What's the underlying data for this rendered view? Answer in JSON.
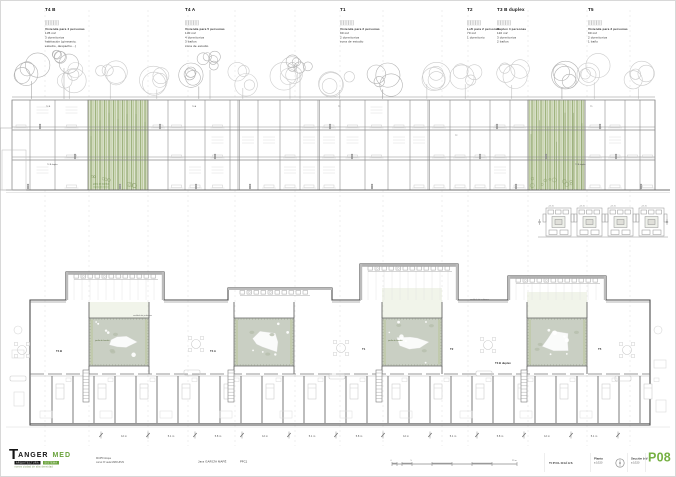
{
  "typologies": [
    {
      "x": 45,
      "label": "T4 B",
      "lines": [
        "Vivienda para 4 personas",
        "135 m2",
        "3 dormitorios",
        "habitación (gimnasio,",
        "estudio, despacho...)"
      ]
    },
    {
      "x": 185,
      "label": "T4 A",
      "lines": [
        "Vivienda para 5 personas",
        "130 m2",
        "4 dormitorios",
        "3 baños",
        "zona de estudio"
      ]
    },
    {
      "x": 340,
      "label": "T1",
      "lines": [
        "Vivienda para 2 personas",
        "90 m2",
        "2 dormitorios",
        "zona de estudio"
      ]
    },
    {
      "x": 467,
      "label": "T2",
      "lines": [
        "Loft para 2 personas",
        "70 m2",
        "1 dormitorio"
      ]
    },
    {
      "x": 497,
      "label": "T3 B duplex",
      "lines": [
        "Duplex 4 personas",
        "110 m2",
        "3 dormitorios",
        "2 baños"
      ]
    },
    {
      "x": 588,
      "label": "T5",
      "lines": [
        "Vivienda para 3 personas",
        "90 m2",
        "2 dormitorios",
        "1 baño"
      ]
    }
  ],
  "section": {
    "atrium_label_lines": [
      "patio de bambú",
      "vegetación interior"
    ],
    "room_labels": [
      {
        "x": 46,
        "y": 107,
        "t": "T4 B"
      },
      {
        "x": 47,
        "y": 165,
        "t": "T4 B duplex"
      },
      {
        "x": 192,
        "y": 107,
        "t": "T4 A"
      },
      {
        "x": 338,
        "y": 107,
        "t": "T1"
      },
      {
        "x": 455,
        "y": 136,
        "t": "T2"
      },
      {
        "x": 575,
        "y": 165,
        "t": "T3 B duplex"
      },
      {
        "x": 590,
        "y": 107,
        "t": "T5"
      }
    ]
  },
  "keyplan": {
    "levels": [
      "+05.20",
      "+05.20",
      "+05.20",
      "+05.20"
    ]
  },
  "plan": {
    "unit_labels": [
      {
        "x": 56,
        "y": 352,
        "t": "T4 B"
      },
      {
        "x": 210,
        "y": 352,
        "t": "T4 A"
      },
      {
        "x": 362,
        "y": 350,
        "t": "T1"
      },
      {
        "x": 450,
        "y": 350,
        "t": "T2"
      },
      {
        "x": 495,
        "y": 364,
        "t": "T3 B duplex"
      },
      {
        "x": 598,
        "y": 350,
        "t": "T5"
      }
    ],
    "notes": [
      {
        "x": 133,
        "y": 316,
        "t": "vestíbulo de jardineras"
      },
      {
        "x": 470,
        "y": 300,
        "t": "vestíbulo de jardineras"
      }
    ],
    "courtyard_labels": [
      {
        "x": 95,
        "y": 341,
        "t": "jardín de bambú"
      },
      {
        "x": 388,
        "y": 341,
        "t": "jardín de bambú"
      }
    ]
  },
  "dimensions": {
    "ticks": [
      101,
      148,
      195,
      242,
      289,
      336,
      383,
      430,
      477,
      524,
      571,
      618
    ],
    "labels": [
      {
        "x": 124,
        "t": "12 m"
      },
      {
        "x": 171,
        "t": "5.1 m"
      },
      {
        "x": 218,
        "t": "5.8 m"
      },
      {
        "x": 265,
        "t": "12 m"
      },
      {
        "x": 312,
        "t": "5.1 m"
      },
      {
        "x": 359,
        "t": "5.8 m"
      },
      {
        "x": 406,
        "t": "12 m"
      },
      {
        "x": 453,
        "t": "5.1 m"
      },
      {
        "x": 500,
        "t": "5.8 m"
      },
      {
        "x": 547,
        "t": "12 m"
      },
      {
        "x": 594,
        "t": "5.1 m"
      }
    ]
  },
  "titleblock": {
    "logo": {
      "initial": "T",
      "rest": "ANGER",
      "med": "MED",
      "bar1": "ARQUITECTURA",
      "bar2": "SISTEMA",
      "caption": "nueva ciudad de alta densidad"
    },
    "credits": [
      "MUP5 bloque",
      "curso Nº aula MMCUP29"
    ],
    "author": "Jara GARCÍA MAFÉ",
    "code": "PFC1",
    "scale_labels": {
      "zero": "0",
      "mid": "5",
      "end": "25 m"
    },
    "tipologias": "TIPOLOGÍAS",
    "planta_title": "Planta",
    "planta_scale": "a 1/150",
    "seccion_title": "Sección b-b'",
    "seccion_scale": "a 1/150",
    "page": "P08"
  },
  "colors": {
    "accent": "#76b043",
    "bamboo_dark": "#9fb37e",
    "bamboo_mid": "#bcc99e",
    "bamboo_light": "#dde4cf",
    "courtyard": "#c9cfc3"
  }
}
